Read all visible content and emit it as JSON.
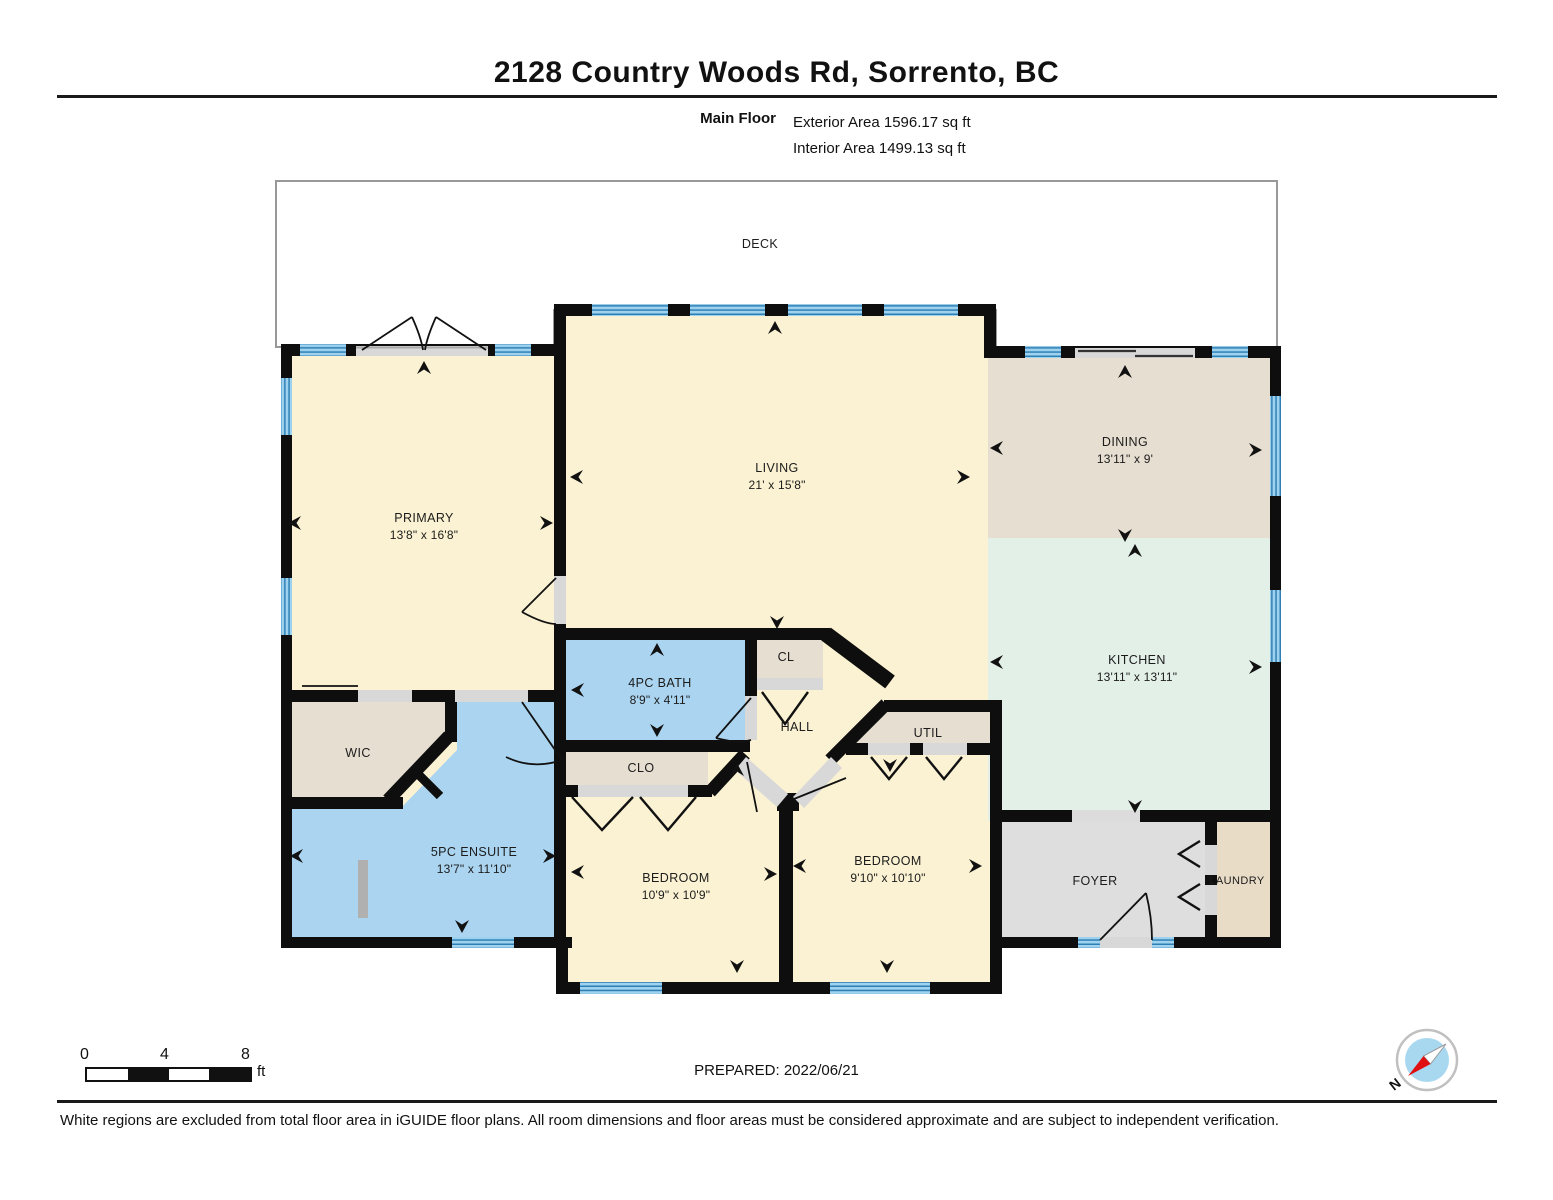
{
  "header": {
    "title": "2128 Country Woods Rd, Sorrento, BC",
    "floor_label": "Main Floor",
    "exterior_area": "Exterior Area 1596.17 sq ft",
    "interior_area": "Interior Area 1499.13 sq ft"
  },
  "rooms": {
    "deck": {
      "name": "DECK"
    },
    "primary": {
      "name": "PRIMARY",
      "dims": "13'8\" x 16'8\""
    },
    "living": {
      "name": "LIVING",
      "dims": "21' x 15'8\""
    },
    "dining": {
      "name": "DINING",
      "dims": "13'11\" x 9'"
    },
    "kitchen": {
      "name": "KITCHEN",
      "dims": "13'11\" x 13'11\""
    },
    "bath": {
      "name": "4PC BATH",
      "dims": "8'9\" x 4'11\""
    },
    "cl": {
      "name": "CL"
    },
    "hall": {
      "name": "HALL"
    },
    "util": {
      "name": "UTIL"
    },
    "wic": {
      "name": "WIC"
    },
    "clo": {
      "name": "CLO"
    },
    "ensuite": {
      "name": "5PC ENSUITE",
      "dims": "13'7\" x 11'10\""
    },
    "bedroom_left": {
      "name": "BEDROOM",
      "dims": "10'9\" x 10'9\""
    },
    "bedroom_right": {
      "name": "BEDROOM",
      "dims": "9'10\" x 10'10\""
    },
    "foyer": {
      "name": "FOYER"
    },
    "laundry": {
      "name": "LAUNDRY"
    }
  },
  "scale_bar": {
    "tick0": "0",
    "tick4": "4",
    "tick8": "8",
    "unit": "ft"
  },
  "compass": {
    "north_label": "N"
  },
  "footer": {
    "prepared": "PREPARED: 2022/06/21",
    "disclaimer": "White regions are excluded from total floor area in iGUIDE floor plans. All room dimensions and floor areas must be considered approximate and are subject to independent verification."
  },
  "colors": {
    "wall": "#0e0e0e",
    "room_cream": "#faf2d2",
    "room_tan": "#e6ded0",
    "room_mint": "#e3f0e8",
    "room_blue": "#aad4f0",
    "room_gray": "#dedede",
    "room_laundry": "#e8dcc7",
    "window_base": "#9ed2ee",
    "window_stripe": "#2e7fb5",
    "door_opening": "#d8d8d8",
    "compass_blue": "#a8d8f0",
    "compass_needle_red": "#e01010"
  }
}
